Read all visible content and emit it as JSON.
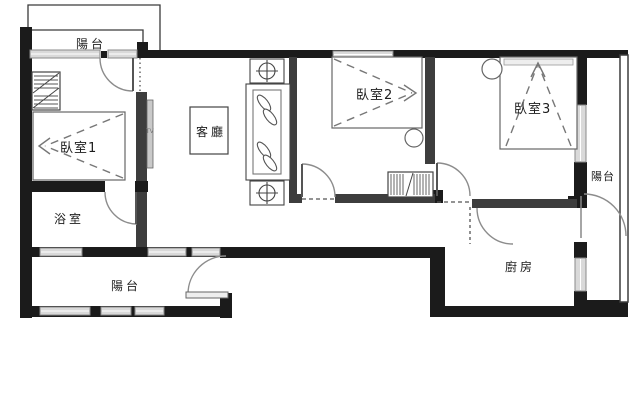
{
  "plan": {
    "title_hint": "apartment floor plan",
    "rooms": {
      "balcony_top": {
        "label": "陽台"
      },
      "bedroom1": {
        "label": "臥室1"
      },
      "living_room": {
        "label": "客廳"
      },
      "bedroom2": {
        "label": "臥室2"
      },
      "bedroom3": {
        "label": "臥室3"
      },
      "bathroom": {
        "label": "浴室"
      },
      "balcony_bottom": {
        "label": "陽台"
      },
      "balcony_right": {
        "label": "陽台"
      },
      "kitchen": {
        "label": "廚房"
      }
    },
    "annotations": {
      "tv": "TV"
    },
    "colors": {
      "wall": "#1b1b1b",
      "partition": "#3d3d3d",
      "window_fill": "#d9d9d9",
      "window_edge": "#8a8a8a",
      "door_arc": "#8c8c8c",
      "furniture_line": "#555555",
      "background": "#ffffff"
    }
  }
}
